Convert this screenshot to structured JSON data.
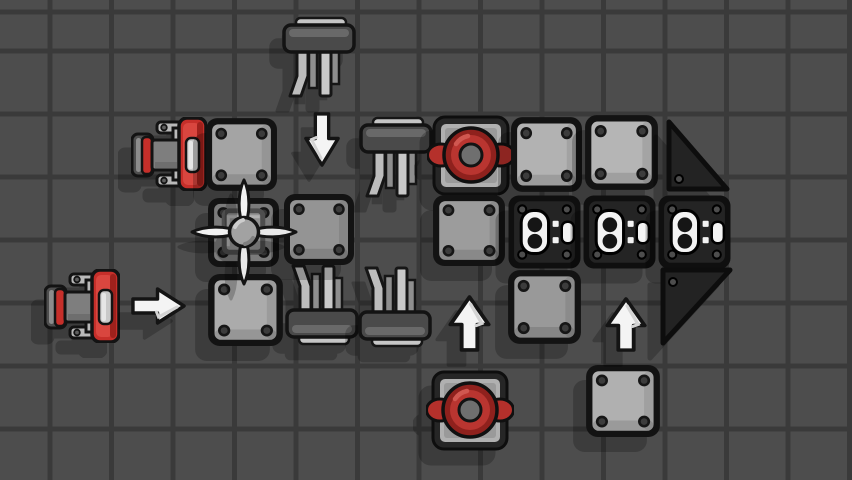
{
  "scene": {
    "canvas": {
      "width": 852,
      "height": 480
    },
    "background": {
      "color": "#4d4d4d",
      "grid": {
        "line_color": "#3a3a3a",
        "line_width": 5,
        "spacing_x": 61.5,
        "spacing_y": 63,
        "offset_x": 47.5,
        "offset_y": 14.5
      }
    },
    "palette": {
      "block_outline": "#131313",
      "plate_gray": "#a8a8a8",
      "dark_block": "#242424",
      "accent_red": "#c62f2a",
      "fan_red_ring": "#8f211d",
      "fan_red_disc": "#b93530",
      "cockpit_panel": "#abc9cb",
      "cockpit_teal": "#2c7176",
      "seat_yellow": "#dcc84a",
      "arrow_white": "#f4f4f4",
      "strut_gray": "#c9c9c9",
      "shadow": "rgba(0,0,0,0.22)"
    },
    "objects": [
      {
        "name": "strut-block-1",
        "type": "strut_down",
        "x": 282,
        "y": 16,
        "w": 75,
        "h": 84
      },
      {
        "name": "strut-block-2",
        "type": "strut_down",
        "x": 359,
        "y": 116,
        "w": 75,
        "h": 84
      },
      {
        "name": "strut-block-3",
        "type": "strut_up",
        "x": 285,
        "y": 262,
        "w": 75,
        "h": 84
      },
      {
        "name": "strut-block-4",
        "type": "strut_up",
        "x": 358,
        "y": 264,
        "w": 75,
        "h": 84
      },
      {
        "name": "engine-block-1",
        "type": "engine",
        "x": 131,
        "y": 117,
        "w": 76,
        "h": 74
      },
      {
        "name": "metal-plate-1",
        "type": "plate",
        "x": 204,
        "y": 116,
        "w": 75,
        "h": 77,
        "fill": "#a4a4a4"
      },
      {
        "name": "fan-block-1",
        "type": "fan",
        "x": 427,
        "y": 114,
        "w": 88,
        "h": 83
      },
      {
        "name": "metal-plate-2",
        "type": "plate",
        "x": 509,
        "y": 115,
        "w": 75,
        "h": 79,
        "fill": "#b2b2b2"
      },
      {
        "name": "metal-plate-3",
        "type": "plate",
        "x": 583,
        "y": 113,
        "w": 77,
        "h": 79,
        "fill": "#b5b5b5"
      },
      {
        "name": "wedge-block-1",
        "type": "wedge_n",
        "x": 664,
        "y": 119,
        "w": 67,
        "h": 73
      },
      {
        "name": "propeller-mount-block",
        "type": "mount",
        "x": 206,
        "y": 196,
        "w": 75,
        "h": 73
      },
      {
        "name": "metal-plate-4",
        "type": "plate",
        "x": 282,
        "y": 192,
        "w": 74,
        "h": 75,
        "fill": "#949494"
      },
      {
        "name": "pilot-seat-block",
        "type": "cockpit",
        "x": 356,
        "y": 192,
        "w": 83,
        "h": 76
      },
      {
        "name": "metal-plate-5",
        "type": "plate",
        "x": 431,
        "y": 193,
        "w": 76,
        "h": 75,
        "fill": "#9c9c9c"
      },
      {
        "name": "connector-block-1",
        "type": "connector",
        "x": 507,
        "y": 194,
        "w": 75,
        "h": 76
      },
      {
        "name": "connector-block-2",
        "type": "connector",
        "x": 582,
        "y": 194,
        "w": 75,
        "h": 76
      },
      {
        "name": "connector-block-3",
        "type": "connector",
        "x": 657,
        "y": 194,
        "w": 75,
        "h": 76
      },
      {
        "name": "engine-block-2",
        "type": "engine",
        "x": 44,
        "y": 269,
        "w": 76,
        "h": 74
      },
      {
        "name": "metal-plate-6",
        "type": "plate",
        "x": 206,
        "y": 272,
        "w": 79,
        "h": 76,
        "fill": "#ababab"
      },
      {
        "name": "metal-plate-7",
        "type": "plate",
        "x": 506,
        "y": 268,
        "w": 77,
        "h": 78,
        "fill": "#999999"
      },
      {
        "name": "wedge-block-2",
        "type": "wedge_s",
        "x": 659,
        "y": 266,
        "w": 75,
        "h": 81
      },
      {
        "name": "fan-block-2",
        "type": "fan",
        "x": 426,
        "y": 369,
        "w": 88,
        "h": 83
      },
      {
        "name": "metal-plate-8",
        "type": "plate",
        "x": 584,
        "y": 363,
        "w": 78,
        "h": 76,
        "fill": "#b0b0b0"
      },
      {
        "name": "propeller-blades",
        "type": "propeller",
        "x": 188,
        "y": 176,
        "w": 112,
        "h": 112
      },
      {
        "name": "thrust-arrow-down",
        "type": "arrow_down",
        "x": 303,
        "y": 111,
        "w": 38,
        "h": 57
      },
      {
        "name": "thrust-arrow-right",
        "type": "arrow_right",
        "x": 130,
        "y": 286,
        "w": 57,
        "h": 40
      },
      {
        "name": "thrust-arrow-up-1",
        "type": "arrow_up",
        "x": 447,
        "y": 294,
        "w": 45,
        "h": 59
      },
      {
        "name": "thrust-arrow-up-2",
        "type": "arrow_up",
        "x": 604,
        "y": 296,
        "w": 44,
        "h": 57
      }
    ]
  }
}
